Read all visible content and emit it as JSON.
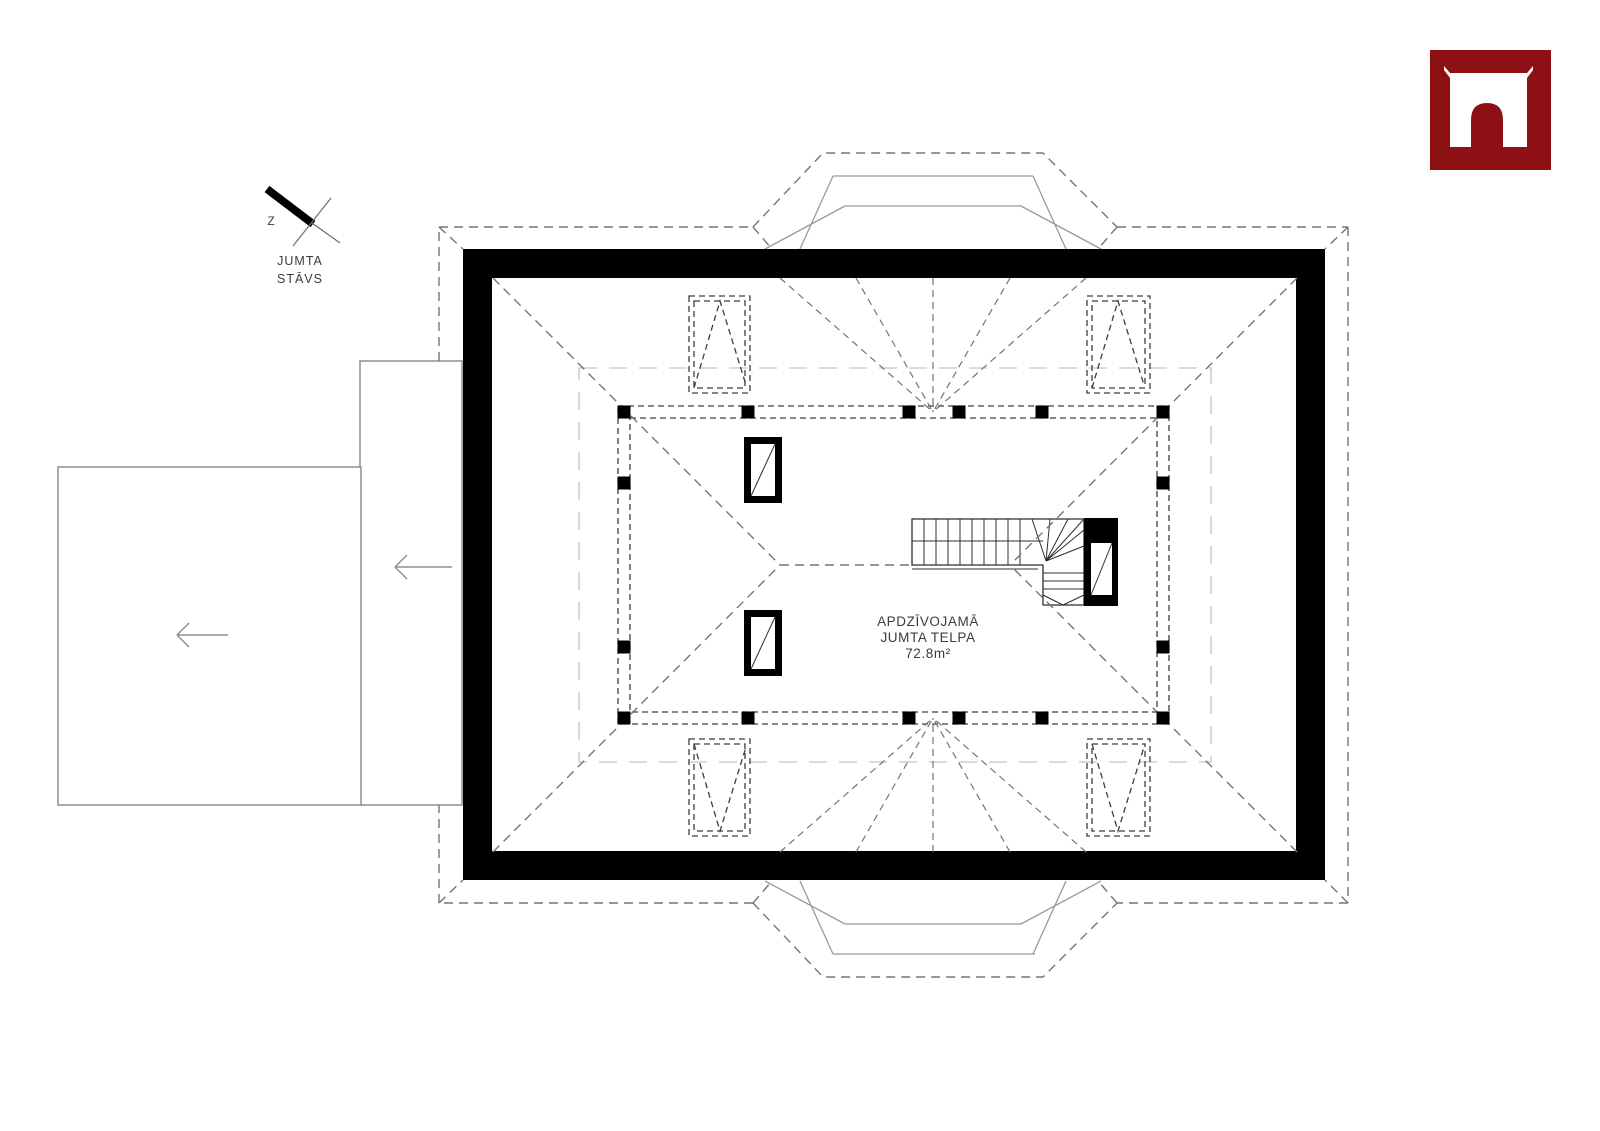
{
  "drawing": {
    "type": "architectural roof floor plan",
    "north_symbol": {
      "label": "Z"
    },
    "title": {
      "line1": "JUMTA",
      "line2": "STĀVS"
    },
    "room_label": {
      "line1": "APDZĪVOJAMĀ",
      "line2": "JUMTA TELPA",
      "area": "72.8m²"
    }
  },
  "logo": {
    "name": "arch-portal-icon",
    "background": "#8d1114",
    "foreground": "#ffffff"
  },
  "colors": {
    "wall": "#000000",
    "dash_dark": "#3d3d3d",
    "dash_gray": "#757575",
    "line_light": "#9a9a9a",
    "line_faint": "#c4c4c4",
    "garage_line": "#8f8f8f",
    "stair_line": "#2f2f2f",
    "text": "#3b3b3b"
  }
}
